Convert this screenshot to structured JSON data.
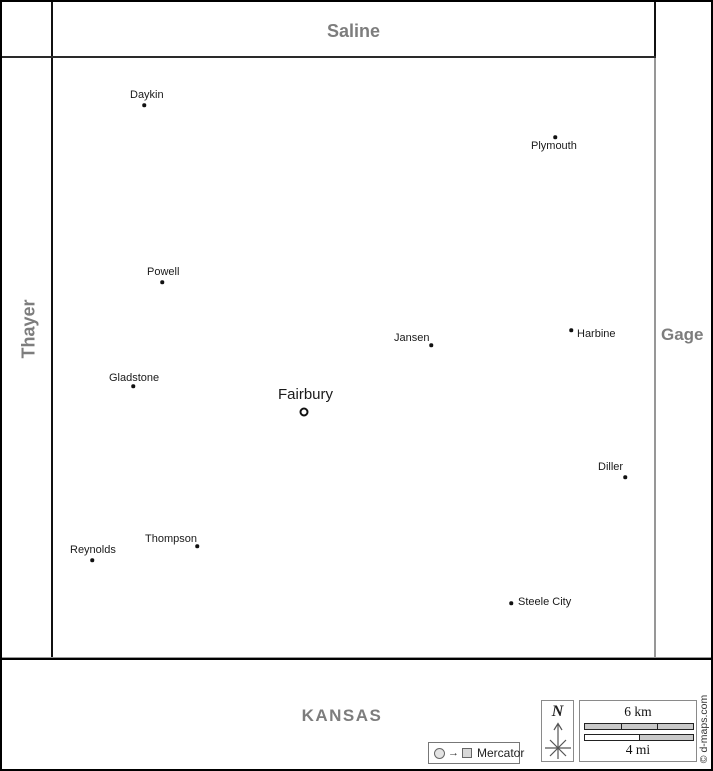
{
  "neighbor_regions": {
    "top": "Saline",
    "left": "Thayer",
    "right": "Gage",
    "bottom": "KANSAS"
  },
  "county_seat": {
    "name": "Fairbury"
  },
  "towns": [
    {
      "name": "Daykin"
    },
    {
      "name": "Plymouth"
    },
    {
      "name": "Powell"
    },
    {
      "name": "Jansen"
    },
    {
      "name": "Harbine"
    },
    {
      "name": "Gladstone"
    },
    {
      "name": "Diller"
    },
    {
      "name": "Thompson"
    },
    {
      "name": "Reynolds"
    },
    {
      "name": "Steele City"
    }
  ],
  "legend": {
    "projection_label": "Mercator",
    "projection_arrow": "→",
    "north_label": "N",
    "scale_km_label": "6 km",
    "scale_mi_label": "4 mi",
    "copyright": "© d-maps.com"
  },
  "colors": {
    "county_label": "#7d7d7d",
    "town_text": "#1a1a1a",
    "border_line": "#111111",
    "scale_bar_fill": "#c9c9c9"
  }
}
